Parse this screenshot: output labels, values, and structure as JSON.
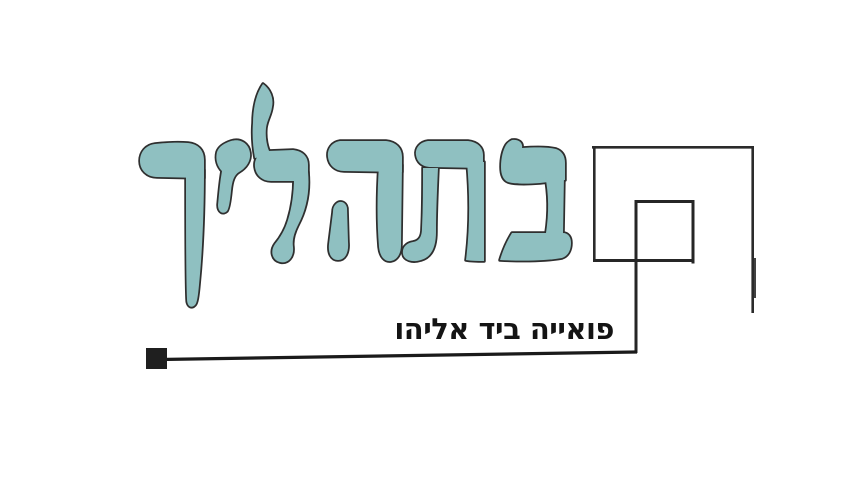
{
  "page": {
    "background_color": "#FFFFFF",
    "width_px": 847,
    "height_px": 501
  },
  "logo": {
    "wordmark_text": "בתהליך",
    "wordmark_color": "#8FC0C1",
    "wordmark_outline_color": "#2F2F2F",
    "subtitle_text": "פואייה ביד אליהו",
    "subtitle_color": "#141414",
    "graphics": {
      "frame_line_color": "#2B2B2B",
      "square_line_color": "#262626",
      "rule_line_color": "#1A1A1A",
      "marker_color": "#1F1F1F",
      "tick_color": "#111111",
      "elements": [
        "outer-frame",
        "inner-square",
        "inner-square-drop-line",
        "baseline-rule",
        "square-marker",
        "right-tick"
      ]
    }
  }
}
